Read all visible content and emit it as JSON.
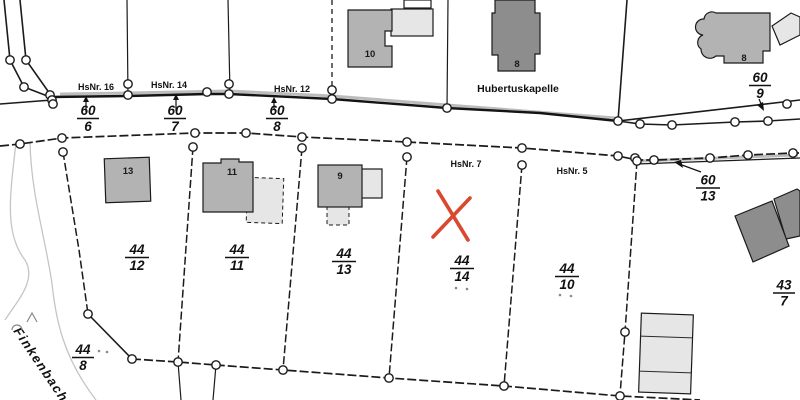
{
  "map": {
    "kind": "cadastral-parcel-map",
    "region_labels": {
      "street_name": "Finkenbach",
      "poi_name": "Hubertuskapelle"
    },
    "house_numbers": {
      "h16": "HsNr. 16",
      "h14": "HsNr. 14",
      "h12": "HsNr. 12",
      "h7": "HsNr. 7",
      "h5": "HsNr. 5"
    },
    "building_numbers": {
      "b10": "10",
      "b8_chapel": "8",
      "b8_ne": "8",
      "b13": "13",
      "b11": "11",
      "b9": "9"
    },
    "parcels": {
      "p60_6": {
        "num": "60",
        "den": "6"
      },
      "p60_7": {
        "num": "60",
        "den": "7"
      },
      "p60_8": {
        "num": "60",
        "den": "8"
      },
      "p60_9": {
        "num": "60",
        "den": "9"
      },
      "p60_13": {
        "num": "60",
        "den": "13"
      },
      "p44_12": {
        "num": "44",
        "den": "12"
      },
      "p44_11": {
        "num": "44",
        "den": "11"
      },
      "p44_13": {
        "num": "44",
        "den": "13"
      },
      "p44_14": {
        "num": "44",
        "den": "14"
      },
      "p44_10": {
        "num": "44",
        "den": "10"
      },
      "p44_8": {
        "num": "44",
        "den": "8"
      },
      "p43_7": {
        "num": "43",
        "den": "7"
      }
    },
    "marker": {
      "type": "red-x",
      "color": "#d9482f",
      "on_parcel": "44/14"
    },
    "colors": {
      "building_gray": "#b3b3b3",
      "building_dark": "#8d8d8d",
      "building_light": "#e6e6e6",
      "line_black": "#1b1b1b",
      "stream_gray": "#c5c5c5",
      "road_shade": "#bcbcbc"
    }
  }
}
